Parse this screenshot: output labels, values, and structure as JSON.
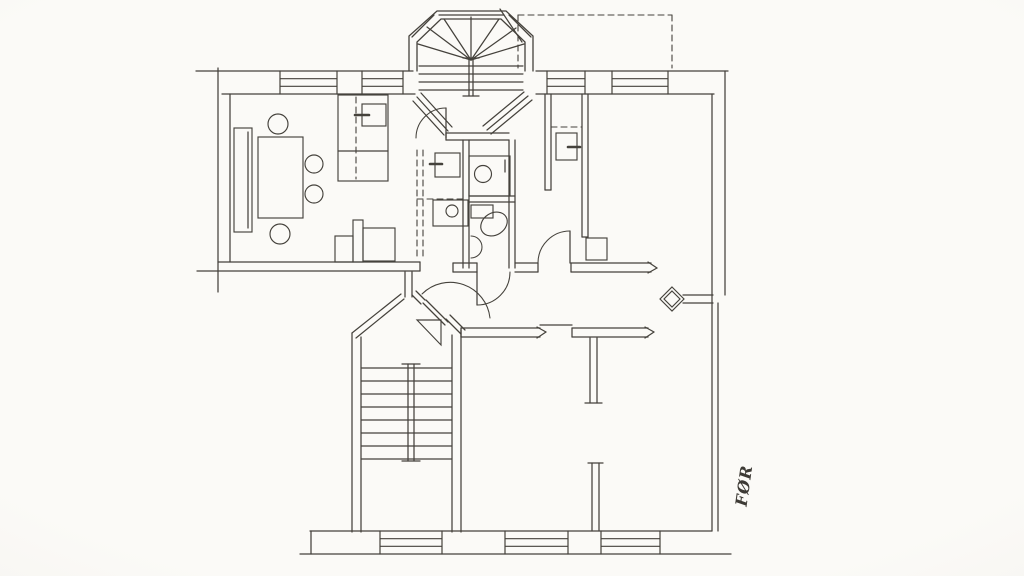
{
  "annotation": {
    "label": "FØR"
  },
  "palette": {
    "paper": "#fbfaf7",
    "ink": "#45423c"
  },
  "plan": {
    "canvas": {
      "w": 1024,
      "h": 576
    },
    "lines": [
      [
        "wall-top-outer-left",
        196,
        71,
        413,
        71
      ],
      [
        "wall-top-outer-right",
        536,
        71,
        728,
        71
      ],
      [
        "wall-top-inner-left",
        222,
        94,
        415,
        94
      ],
      [
        "wall-top-inner-right",
        536,
        94,
        714,
        94
      ],
      [
        "wall-left-outer",
        218,
        68,
        218,
        292
      ],
      [
        "wall-left-inner",
        230,
        94,
        230,
        262
      ],
      [
        "wall-living-south-inner",
        218,
        262,
        420,
        262
      ],
      [
        "wall-living-south-outer",
        197,
        271,
        420,
        271
      ],
      [
        "wall-living-south-cap",
        420,
        262,
        420,
        271
      ],
      [
        "wall-hall-stub-a",
        405,
        272,
        405,
        297
      ],
      [
        "wall-hall-stub-b",
        412,
        272,
        412,
        297
      ],
      [
        "wall-kitchen-wc-a",
        463,
        140,
        463,
        268
      ],
      [
        "wall-kitchen-wc-b",
        469,
        140,
        469,
        268
      ],
      [
        "wall-bay-south-a",
        446,
        133,
        509,
        133
      ],
      [
        "wall-bay-south-b",
        446,
        140,
        509,
        140
      ],
      [
        "wall-bay-south-cap",
        446,
        133,
        446,
        140
      ],
      [
        "wall-wc-east-a",
        509,
        140,
        509,
        268
      ],
      [
        "wall-wc-east-b",
        515,
        140,
        515,
        268
      ],
      [
        "wall-wc-divider-a",
        469,
        196,
        515,
        196
      ],
      [
        "wall-wc-divider-b",
        469,
        202,
        515,
        202
      ],
      [
        "wall-hall-north-1a",
        453,
        263,
        477,
        263
      ],
      [
        "wall-hall-north-1b",
        453,
        272,
        477,
        272
      ],
      [
        "wall-hall-north-1cap-l",
        453,
        263,
        453,
        272
      ],
      [
        "wall-hall-north-1cap-r",
        477,
        263,
        477,
        272
      ],
      [
        "wall-hall-north-2a",
        515,
        263,
        538,
        263
      ],
      [
        "wall-hall-north-2b",
        515,
        272,
        538,
        272
      ],
      [
        "wall-hall-north-2cap",
        538,
        263,
        538,
        272
      ],
      [
        "wall-hall-north-3a",
        571,
        263,
        651,
        263
      ],
      [
        "wall-hall-north-3b",
        571,
        272,
        651,
        272
      ],
      [
        "wall-hall-north-3cap",
        571,
        263,
        571,
        272
      ],
      [
        "wall-arrow-ne-1",
        648,
        262,
        657,
        268
      ],
      [
        "wall-arrow-ne-2",
        648,
        273,
        657,
        268
      ],
      [
        "wall-closet-west-a",
        545,
        94,
        545,
        190
      ],
      [
        "wall-closet-west-b",
        551,
        94,
        551,
        190
      ],
      [
        "wall-closet-west-cap",
        545,
        190,
        551,
        190
      ],
      [
        "wall-closet-east-a",
        582,
        94,
        582,
        237
      ],
      [
        "wall-closet-east-b",
        588,
        94,
        588,
        237
      ],
      [
        "wall-closet-east-cap",
        582,
        237,
        588,
        237
      ],
      [
        "wall-flue-stub-a",
        683,
        295,
        713,
        295
      ],
      [
        "wall-flue-stub-b",
        683,
        303,
        713,
        303
      ],
      [
        "wall-hall-south-1a",
        461,
        328,
        540,
        328
      ],
      [
        "wall-hall-south-1b",
        461,
        337,
        540,
        337
      ],
      [
        "wall-hall-south-1cap",
        461,
        328,
        461,
        337
      ],
      [
        "wall-arrow-s1a",
        537,
        327,
        546,
        332
      ],
      [
        "wall-arrow-s1b",
        537,
        338,
        546,
        332
      ],
      [
        "door-lintel",
        540,
        325,
        572,
        325
      ],
      [
        "wall-hall-south-2a",
        572,
        328,
        648,
        328
      ],
      [
        "wall-hall-south-2b",
        572,
        337,
        648,
        337
      ],
      [
        "wall-hall-south-2cap",
        572,
        328,
        572,
        337
      ],
      [
        "wall-arrow-s2a",
        645,
        327,
        654,
        332
      ],
      [
        "wall-arrow-s2b",
        645,
        338,
        654,
        332
      ],
      [
        "wall-t-stem-a",
        590,
        338,
        590,
        403
      ],
      [
        "wall-t-stem-b",
        597,
        338,
        597,
        403
      ],
      [
        "wall-t-stem-cap",
        585,
        403,
        602,
        403
      ],
      [
        "wall-br-stub-a",
        592,
        463,
        592,
        531
      ],
      [
        "wall-br-stub-b",
        599,
        463,
        599,
        531
      ],
      [
        "wall-br-stub-cap",
        588,
        463,
        603,
        463
      ],
      [
        "wall-stair-west-a",
        352,
        333,
        352,
        532
      ],
      [
        "wall-stair-west-b",
        361,
        337,
        361,
        532
      ],
      [
        "wall-stair-east-a",
        452,
        335,
        452,
        532
      ],
      [
        "wall-stair-east-b",
        461,
        330,
        461,
        532
      ],
      [
        "wall-chamfer-left-1",
        352,
        333,
        401,
        294
      ],
      [
        "wall-chamfer-left-2",
        356,
        338,
        404,
        299
      ],
      [
        "wall-chamfer-right-up-1",
        412,
        295,
        421,
        304
      ],
      [
        "wall-chamfer-right-up-2",
        416,
        291,
        425,
        300
      ],
      [
        "wall-chamfer-right-low-1",
        446,
        319,
        461,
        334
      ],
      [
        "wall-chamfer-right-low-2",
        450,
        315,
        465,
        330
      ],
      [
        "wall-bottom-inner",
        310,
        531,
        712,
        531
      ],
      [
        "wall-bottom-outer",
        300,
        554,
        731,
        554
      ],
      [
        "wall-bottom-cap-l",
        311,
        531,
        311,
        554
      ],
      [
        "wall-right-inner",
        712,
        94,
        712,
        531
      ],
      [
        "wall-right-outer-upper",
        725,
        71,
        725,
        295
      ],
      [
        "wall-right-outer-lower",
        718,
        303,
        718,
        531
      ],
      [
        "stair-rail-a",
        408,
        364,
        408,
        461
      ],
      [
        "stair-rail-b",
        414,
        364,
        414,
        461
      ],
      [
        "stair-rail-cap-top",
        402,
        364,
        420,
        364
      ],
      [
        "stair-rail-cap-bottom",
        402,
        461,
        420,
        461
      ],
      [
        "bay-sill-top",
        439,
        15,
        504,
        15
      ],
      [
        "bay-window-tl",
        434,
        15,
        412,
        37
      ],
      [
        "bay-window-tr",
        509,
        15,
        531,
        37
      ],
      [
        "tower-post-a",
        469,
        58,
        469,
        96
      ],
      [
        "tower-post-b",
        473,
        58,
        473,
        96
      ],
      [
        "tower-post-cap-top",
        463,
        58,
        479,
        58
      ],
      [
        "tower-post-cap-bottom",
        463,
        96,
        479,
        96
      ],
      [
        "tower-fan-1",
        471,
        60,
        418,
        44
      ],
      [
        "tower-fan-2",
        471,
        60,
        427,
        27
      ],
      [
        "tower-fan-3",
        471,
        60,
        444,
        19
      ],
      [
        "tower-fan-4",
        471,
        60,
        471,
        17
      ],
      [
        "tower-fan-5",
        471,
        60,
        499,
        19
      ],
      [
        "tower-fan-6",
        471,
        60,
        516,
        28
      ],
      [
        "tower-fan-7",
        471,
        60,
        524,
        44
      ],
      [
        "bay-window-ll-1",
        413,
        101,
        444,
        135
      ],
      [
        "bay-window-ll-2",
        417,
        97,
        448,
        131
      ],
      [
        "bay-window-ll-3",
        421,
        93,
        452,
        127
      ],
      [
        "bay-window-lr-1",
        532,
        100,
        491,
        134
      ],
      [
        "bay-window-lr-2",
        528,
        96,
        487,
        130
      ],
      [
        "bay-window-lr-3",
        524,
        92,
        483,
        126
      ],
      [
        "balcony-leader",
        500,
        9,
        522,
        42
      ],
      [
        "wc-tap-tick",
        505,
        160,
        505,
        172
      ],
      [
        "stove-tick-living",
        355,
        115,
        369,
        115,
        2.6
      ],
      [
        "stove-tick-kitchen",
        430,
        164,
        442,
        164,
        2.6
      ],
      [
        "stove-tick-closet",
        568,
        147,
        580,
        147,
        2.6
      ],
      [
        "sideboard-inner-line",
        248,
        132,
        248,
        228
      ],
      [
        "cabinet-divider",
        338,
        151,
        388,
        151
      ],
      [
        "door-leaf-bay",
        446,
        108,
        446,
        138
      ],
      [
        "door-leaf-wc",
        477,
        272,
        477,
        305
      ],
      [
        "door-leaf-room",
        570,
        231,
        570,
        263
      ],
      [
        "door-leaf-landing-1",
        423,
        303,
        445,
        325
      ],
      [
        "door-leaf-landing-2",
        426,
        300,
        448,
        322
      ]
    ],
    "hatches": [
      {
        "n": "backstair-treads",
        "x1": 361,
        "x2": 452,
        "y0": 368,
        "step": 13,
        "count": 8
      },
      {
        "n": "tower-treads",
        "x1": 419,
        "x2": 523,
        "y0": 66,
        "step": 8,
        "count": 4
      }
    ],
    "windows": [
      [
        "window-top-1",
        280,
        71,
        57,
        23
      ],
      [
        "window-top-2",
        362,
        71,
        41,
        23
      ],
      [
        "window-top-3",
        547,
        71,
        38,
        23
      ],
      [
        "window-top-4",
        612,
        71,
        56,
        23
      ],
      [
        "window-bottom-1",
        380,
        531,
        62,
        23
      ],
      [
        "window-bottom-2",
        505,
        531,
        63,
        23
      ],
      [
        "window-bottom-3",
        601,
        531,
        59,
        23
      ]
    ],
    "rects": [
      [
        "sideboard",
        234,
        128,
        18,
        104
      ],
      [
        "dining-table",
        258,
        137,
        45,
        81
      ],
      [
        "cabinet",
        338,
        95,
        50,
        86
      ],
      [
        "cabinet-stove",
        362,
        104,
        24,
        22
      ],
      [
        "counter-small",
        335,
        236,
        18,
        26
      ],
      [
        "counter-bar",
        353,
        220,
        10,
        42
      ],
      [
        "counter-square",
        363,
        228,
        32,
        33
      ],
      [
        "kitchen-stove",
        435,
        153,
        25,
        24
      ],
      [
        "kitchen-counter",
        433,
        200,
        35,
        26
      ],
      [
        "wc-basin",
        469,
        156,
        41,
        40
      ],
      [
        "wc-cistern",
        471,
        205,
        22,
        13
      ],
      [
        "closet-stove",
        556,
        133,
        21,
        27
      ],
      [
        "chimney-pillar",
        586,
        238,
        21,
        22
      ]
    ],
    "circles": [
      [
        "chair-1",
        278,
        124,
        10
      ],
      [
        "chair-2",
        314,
        164,
        9
      ],
      [
        "chair-3",
        314,
        194,
        9
      ],
      [
        "chair-4",
        280,
        234,
        10
      ],
      [
        "kitchen-sink",
        452,
        211,
        6
      ],
      [
        "wc-sink",
        483,
        174,
        8.5
      ]
    ],
    "ellipses": [
      [
        "toilet-bowl",
        494,
        224,
        14,
        11,
        -32
      ]
    ],
    "paths": [
      [
        "wc-corner-sink",
        "M 471,236 A 11 11 0 0 1 471,258"
      ],
      [
        "door-arc-bay",
        "M 416,138 A 30 30 0 0 1 446,108"
      ],
      [
        "door-arc-wc",
        "M 510,272 A 33 33 0 0 1 477,305"
      ],
      [
        "door-arc-room",
        "M 570,231 A 32 32 0 0 0 538,263"
      ],
      [
        "door-arc-landing",
        "M 422,294 A 40 40 0 0 1 490,318"
      ]
    ],
    "polylines": [
      [
        "bay-outer",
        [
          [
            409,
            71
          ],
          [
            409,
            36
          ],
          [
            437,
            11
          ],
          [
            506,
            11
          ],
          [
            533,
            36
          ],
          [
            533,
            71
          ]
        ]
      ],
      [
        "bay-inner",
        [
          [
            417,
            71
          ],
          [
            417,
            42
          ],
          [
            441,
            19
          ],
          [
            501,
            19
          ],
          [
            525,
            42
          ],
          [
            525,
            71
          ]
        ]
      ]
    ],
    "polygons": [
      [
        "stair-triangle",
        [
          [
            417,
            320
          ],
          [
            441,
            320
          ],
          [
            441,
            345
          ]
        ]
      ],
      [
        "flue-diamond-outer",
        [
          [
            672,
            287
          ],
          [
            684,
            299
          ],
          [
            672,
            311
          ],
          [
            660,
            299
          ]
        ]
      ],
      [
        "flue-diamond-inner",
        [
          [
            672,
            291
          ],
          [
            680,
            299
          ],
          [
            672,
            307
          ],
          [
            664,
            299
          ]
        ]
      ]
    ],
    "dashed": [
      [
        "balcony-top",
        518,
        15,
        672,
        15
      ],
      [
        "balcony-left",
        518,
        15,
        518,
        68
      ],
      [
        "balcony-right",
        672,
        15,
        672,
        68
      ],
      [
        "kitchen-dash-1",
        417,
        150,
        417,
        257
      ],
      [
        "kitchen-dash-2",
        423,
        150,
        423,
        257
      ],
      [
        "kitchen-dash-h",
        417,
        199,
        463,
        199
      ],
      [
        "cabinet-dash",
        356,
        97,
        356,
        179
      ],
      [
        "closet-dash",
        551,
        127,
        582,
        127
      ]
    ]
  }
}
